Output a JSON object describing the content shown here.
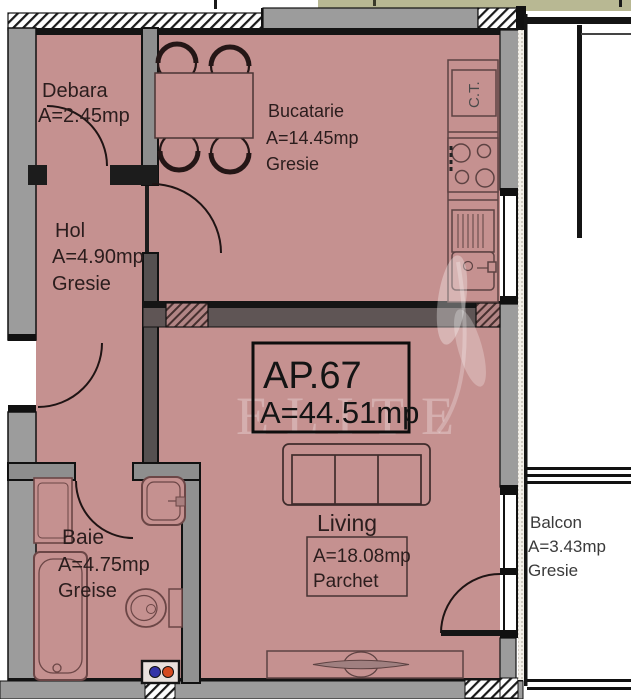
{
  "plan": {
    "type": "apartment-floor-plan",
    "apartment": {
      "id": "AP.67",
      "area": "A=44.51mp"
    },
    "rooms": [
      {
        "name": "Debara",
        "area": "A=2.45mp",
        "floor": ""
      },
      {
        "name": "Bucatarie",
        "area": "A=14.45mp",
        "floor": "Gresie"
      },
      {
        "name": "Hol",
        "area": "A=4.90mp",
        "floor": "Gresie"
      },
      {
        "name": "Living",
        "area": "A=18.08mp",
        "floor": "Parchet"
      },
      {
        "name": "Baie",
        "area": "A=4.75mp",
        "floor": "Greise"
      },
      {
        "name": "Balcon",
        "area": "A=3.43mp",
        "floor": "Gresie"
      }
    ],
    "equipment": {
      "ct_label": "C.T."
    },
    "watermark": {
      "text": "ELITE"
    },
    "colors": {
      "room_fill": "#c59190",
      "wall_gray": "#9c9c9c",
      "wall_dark": "#151515",
      "interior_wall": "#8e8e8e",
      "beam_fill": "#5f5555",
      "neighbor_strip": "#b8b893",
      "furniture_line": "#5d4242",
      "valve_blue": "#3434a8",
      "valve_red": "#d44a20"
    }
  }
}
